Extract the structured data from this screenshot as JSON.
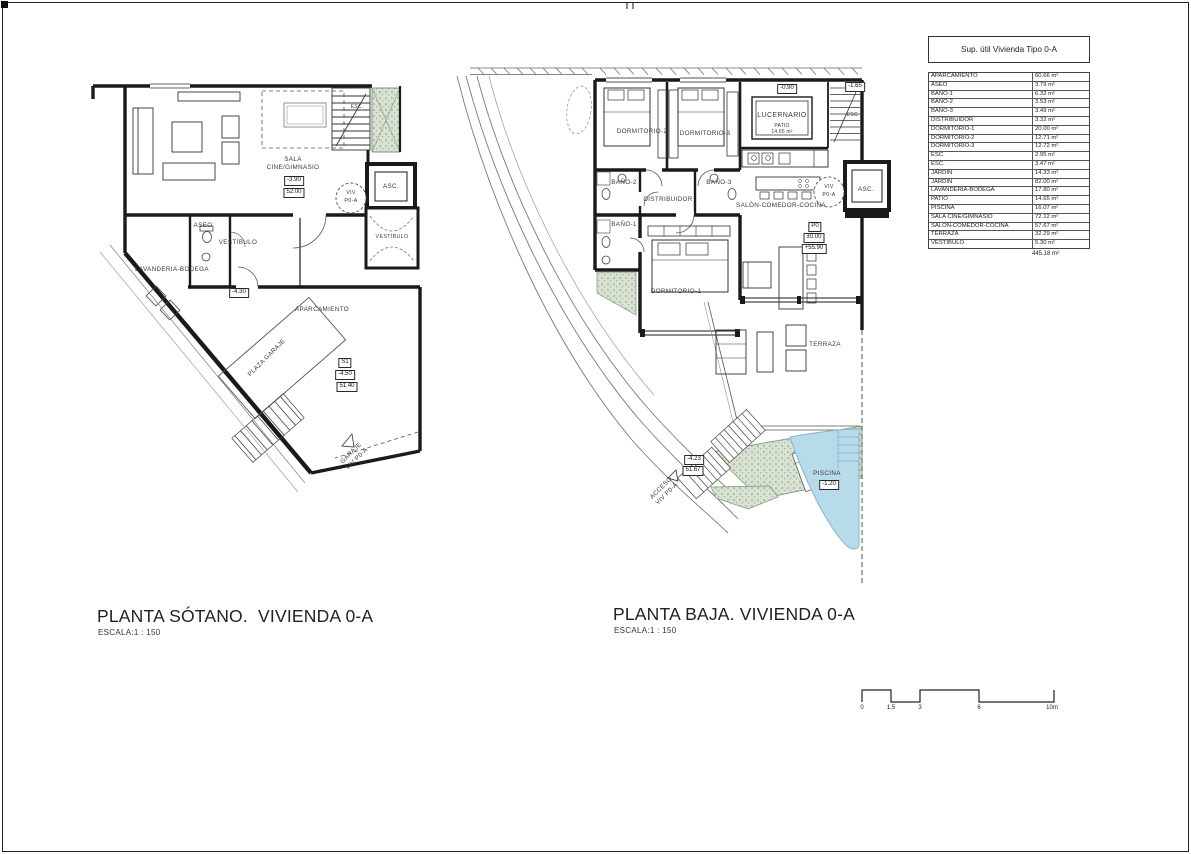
{
  "area_table": {
    "title": "Sup. útil Vivienda Tipo 0-A",
    "rows": [
      {
        "name": "APARCAMIENTO",
        "value": "60.66 m²"
      },
      {
        "name": "ASEO",
        "value": "3.79 m²"
      },
      {
        "name": "BAÑO-1",
        "value": "6.32 m²"
      },
      {
        "name": "BAÑO-2",
        "value": "3.53 m²"
      },
      {
        "name": "BAÑO-3",
        "value": "3.49 m²"
      },
      {
        "name": "DISTRIBUIDOR",
        "value": "3.32 m²"
      },
      {
        "name": "DORMITORIO-1",
        "value": "20.00 m²"
      },
      {
        "name": "DORMITORIO-2",
        "value": "12.71 m²"
      },
      {
        "name": "DORMITORIO-3",
        "value": "12.72 m²"
      },
      {
        "name": "ESC.",
        "value": "2.95 m²"
      },
      {
        "name": "ESC.",
        "value": "3.47 m²"
      },
      {
        "name": "JARDÍN",
        "value": "14.33 m²"
      },
      {
        "name": "JARDÍN",
        "value": "82.00 m²"
      },
      {
        "name": "LAVANDERIA-BODEGA",
        "value": "17.80 m²"
      },
      {
        "name": "PATIO",
        "value": "14.65 m²"
      },
      {
        "name": "PISCINA",
        "value": "16.07 m²"
      },
      {
        "name": "SALA CINE/GIMNASIO",
        "value": "72.12 m²"
      },
      {
        "name": "SALÓN-COMEDOR-COCINA",
        "value": "57.67 m²"
      },
      {
        "name": "TERRAZA",
        "value": "32.29 m²"
      },
      {
        "name": "VESTÍBULO",
        "value": "5.30 m²"
      }
    ],
    "total": "445.18 m²"
  },
  "sotano": {
    "title": "PLANTA SÓTANO.  VIVIENDA 0-A",
    "scale": "ESCALA:1 : 150",
    "labels": {
      "sala_1": "SALA",
      "sala_2": "CINE/GIMNASIO",
      "sala_level": "-3.90",
      "sala_alt": "52.00",
      "esc": "ESC.",
      "viv_1": "VIV",
      "viv_2": "P0-A",
      "asc": "ASC.",
      "vestibulo_right": "VESTÍBULO",
      "aseo": "ASEO",
      "vestibulo": "VESTÍBULO",
      "lavanderia": "LAVANDERIA-BODEGA",
      "ramp_level": "-4.30",
      "aparcamiento": "APARCAMIENTO",
      "plaza_garaje": "PLAZA GARAJE",
      "s1": "S1",
      "s1_level": "-4.50",
      "s1_alt": "51.40",
      "garaje_1": "GARAJE",
      "garaje_2": "VIV P0-A"
    }
  },
  "baja": {
    "title": "PLANTA BAJA. VIVIENDA 0-A",
    "scale": "ESCALA:1 : 150",
    "labels": {
      "dorm2": "DORMITORIO-2",
      "dorm3": "DORMITORIO-3",
      "patio_level": "-0.90",
      "lucernario": "LUCERNARIO",
      "patio": "PATIO",
      "patio_area": "14.65 m²",
      "esc_level": "-1.65",
      "esc": "ESC.",
      "bano2": "BAÑO-2",
      "bano3": "BAÑO-3",
      "distribuidor": "DISTRIBUIDOR",
      "salon": "SALÓN-COMEDOR-COCINA",
      "viv_1": "VIV",
      "viv_2": "P0-A",
      "asc": "ASC.",
      "p0": "P0",
      "p0_level": "±0.00",
      "p0_alt": "+55.90",
      "bano1": "BAÑO-1",
      "dorm1": "DORMITORIO-1",
      "terraza": "TERRAZA",
      "stair_level": "-4.23",
      "stair_alt": "51.67",
      "acceso_1": "ACCESO",
      "acceso_2": "VIV P0-A",
      "piscina": "PISCINA",
      "piscina_level": "-1.20"
    }
  },
  "scale_bar": {
    "t0": "0",
    "t1": "1.5",
    "t2": "3",
    "t3": "6",
    "t4": "10m"
  }
}
